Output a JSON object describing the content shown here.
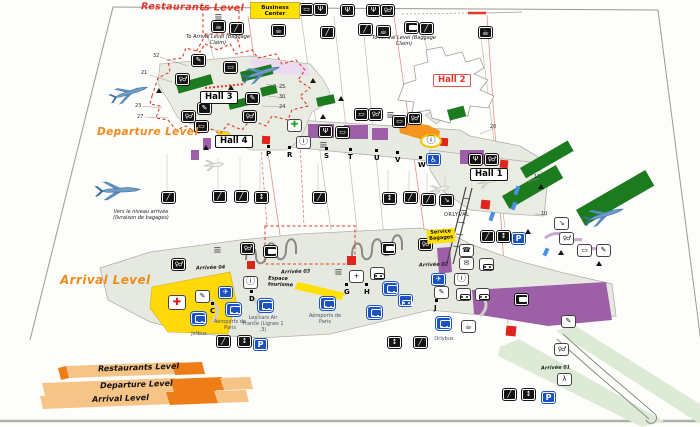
{
  "levels": {
    "restaurants": "Restaurants Level",
    "departure": "Departure Level",
    "arrival": "Arrival Level"
  },
  "legend": {
    "items": [
      "Restaurants Level",
      "Departure Level",
      "Arrival Level"
    ]
  },
  "badges": {
    "business_center": "Business Center",
    "service_bagages": "Service Bagages",
    "espace_tourisme": "Espace tourisme"
  },
  "notes": {
    "to_arrival": "To Arrival Level (Baggage Claim)",
    "vers_niveau": "Vers le niveau arrivée (livraison de bagages)",
    "orlyval": "ORLYVAL"
  },
  "halls": [
    {
      "label": "Hall 3",
      "x": 200,
      "y": 91,
      "cls": ""
    },
    {
      "label": "Hall 4",
      "x": 215,
      "y": 135,
      "cls": ""
    },
    {
      "label": "Hall 2",
      "x": 433,
      "y": 74,
      "cls": "red"
    },
    {
      "label": "Hall 1",
      "x": 470,
      "y": 168,
      "cls": ""
    }
  ],
  "arrival_exits": [
    {
      "label": "Arrivée 04",
      "x": 196,
      "y": 265
    },
    {
      "label": "Arrivée 03",
      "x": 281,
      "y": 269
    },
    {
      "label": "Arrivée 02",
      "x": 419,
      "y": 262
    },
    {
      "label": "Arrivée 01",
      "x": 541,
      "y": 365
    }
  ],
  "gate_letters": [
    {
      "t": "P",
      "x": 266,
      "y": 150
    },
    {
      "t": "R",
      "x": 287,
      "y": 151
    },
    {
      "t": "S",
      "x": 324,
      "y": 152
    },
    {
      "t": "T",
      "x": 348,
      "y": 153
    },
    {
      "t": "U",
      "x": 374,
      "y": 154
    },
    {
      "t": "V",
      "x": 395,
      "y": 156
    },
    {
      "t": "W",
      "x": 418,
      "y": 161
    },
    {
      "t": "C",
      "x": 210,
      "y": 307
    },
    {
      "t": "D",
      "x": 249,
      "y": 295
    },
    {
      "t": "G",
      "x": 344,
      "y": 288
    },
    {
      "t": "H",
      "x": 364,
      "y": 288
    },
    {
      "t": "J",
      "x": 434,
      "y": 304
    }
  ],
  "gate_numbers": [
    {
      "t": "32",
      "x": 153,
      "y": 53
    },
    {
      "t": "21",
      "x": 141,
      "y": 70
    },
    {
      "t": "23",
      "x": 135,
      "y": 103
    },
    {
      "t": "27",
      "x": 137,
      "y": 114
    },
    {
      "t": "25",
      "x": 279,
      "y": 84
    },
    {
      "t": "30",
      "x": 279,
      "y": 94
    },
    {
      "t": "24",
      "x": 279,
      "y": 104
    },
    {
      "t": "20",
      "x": 490,
      "y": 124
    },
    {
      "t": "11",
      "x": 534,
      "y": 174
    },
    {
      "t": "10",
      "x": 541,
      "y": 211
    }
  ],
  "transport": [
    {
      "label": "Jetbus",
      "lx": 184,
      "ly": 331,
      "w": 30,
      "ix": 191,
      "iy": 312,
      "name": "jetbus-stop"
    },
    {
      "label": "Aéroports de Paris",
      "lx": 212,
      "ly": 319,
      "w": 36,
      "ix": 226,
      "iy": 303,
      "name": "aeroports-de-paris-stop"
    },
    {
      "label": "Les cars Air France (Lignes 1 ,3)",
      "lx": 242,
      "ly": 315,
      "w": 42,
      "ix": 258,
      "iy": 299,
      "name": "cars-air-france-stop"
    },
    {
      "label": "Aéroports de Paris",
      "lx": 306,
      "ly": 313,
      "w": 38,
      "ix": 320,
      "iy": 297,
      "name": "aeroports-de-paris-stop-2"
    },
    {
      "label": "Orlybus",
      "lx": 426,
      "ly": 336,
      "w": 36,
      "ix": 436,
      "iy": 317,
      "name": "orlybus-stop"
    }
  ],
  "icons": [
    {
      "n": "flight-info-monitor-icon",
      "t": "monitor",
      "x": 300,
      "y": 4,
      "v": "b"
    },
    {
      "n": "restaurant-icon",
      "t": "restaurant",
      "x": 314,
      "y": 4,
      "v": "b"
    },
    {
      "n": "restaurant-icon",
      "t": "restaurant",
      "x": 341,
      "y": 5,
      "v": "b"
    },
    {
      "n": "restaurant-icon",
      "t": "restaurant",
      "x": 367,
      "y": 5,
      "v": "b"
    },
    {
      "n": "toilets-icon",
      "t": "toilets",
      "x": 381,
      "y": 5,
      "v": "b"
    },
    {
      "n": "shop-shelves-icon",
      "t": "kiosk",
      "x": 212,
      "y": 12,
      "v": "lines"
    },
    {
      "n": "bar-icon",
      "t": "bar",
      "x": 212,
      "y": 21,
      "v": "b"
    },
    {
      "n": "escalator-icon",
      "t": "escalator",
      "x": 230,
      "y": 23,
      "v": "b"
    },
    {
      "n": "bar-icon",
      "t": "bar",
      "x": 272,
      "y": 25,
      "v": "b"
    },
    {
      "n": "escalator-icon",
      "t": "escalator",
      "x": 321,
      "y": 27,
      "v": "b"
    },
    {
      "n": "escalator-icon",
      "t": "escalator",
      "x": 359,
      "y": 24,
      "v": "b"
    },
    {
      "n": "bar-icon",
      "t": "bar",
      "x": 377,
      "y": 26,
      "v": "b"
    },
    {
      "n": "baggage-claim-icon",
      "t": "case",
      "x": 405,
      "y": 22,
      "v": "b"
    },
    {
      "n": "escalator-icon",
      "t": "escalator",
      "x": 420,
      "y": 23,
      "v": "b"
    },
    {
      "n": "bar-icon",
      "t": "bar",
      "x": 479,
      "y": 27,
      "v": "b"
    },
    {
      "n": "smoking-area-icon",
      "t": "smoking",
      "x": 192,
      "y": 55,
      "v": "b"
    },
    {
      "n": "flight-info-monitor-icon",
      "t": "monitor",
      "x": 224,
      "y": 62,
      "v": "b"
    },
    {
      "n": "toilets-icon",
      "t": "toilets",
      "x": 176,
      "y": 74,
      "v": "b"
    },
    {
      "n": "smoking-area-icon",
      "t": "smoking",
      "x": 246,
      "y": 93,
      "v": "b"
    },
    {
      "n": "smoking-area-icon",
      "t": "smoking",
      "x": 198,
      "y": 103,
      "v": "b"
    },
    {
      "n": "toilets-icon",
      "t": "toilets",
      "x": 182,
      "y": 111,
      "v": "b"
    },
    {
      "n": "toilets-icon",
      "t": "toilets",
      "x": 243,
      "y": 111,
      "v": "b"
    },
    {
      "n": "flight-info-monitor-icon",
      "t": "monitor",
      "x": 195,
      "y": 121,
      "v": "b"
    },
    {
      "n": "flight-info-monitor-icon",
      "t": "monitor",
      "x": 355,
      "y": 109,
      "v": "b"
    },
    {
      "n": "toilets-icon",
      "t": "toilets",
      "x": 369,
      "y": 109,
      "v": "b"
    },
    {
      "n": "shop-shelves-icon",
      "t": "kiosk",
      "x": 384,
      "y": 110,
      "v": "lines"
    },
    {
      "n": "pharmacy-icon",
      "t": "pharmacy",
      "x": 288,
      "y": 120,
      "v": "w"
    },
    {
      "n": "restaurant-icon",
      "t": "restaurant",
      "x": 319,
      "y": 126,
      "v": "b"
    },
    {
      "n": "flight-info-monitor-icon",
      "t": "monitor",
      "x": 336,
      "y": 127,
      "v": "b"
    },
    {
      "n": "flight-info-monitor-icon",
      "t": "monitor",
      "x": 393,
      "y": 116,
      "v": "b"
    },
    {
      "n": "toilets-icon",
      "t": "toilets",
      "x": 408,
      "y": 113,
      "v": "b"
    },
    {
      "n": "information-icon",
      "t": "info",
      "x": 297,
      "y": 137,
      "v": "w"
    },
    {
      "n": "checkin-desks-icon",
      "t": "kiosk",
      "x": 317,
      "y": 140,
      "v": "lines"
    },
    {
      "n": "information-desk-icon",
      "t": "info",
      "x": 420,
      "y": 134,
      "v": "o"
    },
    {
      "n": "restaurant-icon",
      "t": "restaurant",
      "x": 469,
      "y": 154,
      "v": "b"
    },
    {
      "n": "toilets-icon",
      "t": "toilets",
      "x": 485,
      "y": 154,
      "v": "b"
    },
    {
      "n": "wheelchair-access-icon",
      "t": "wheelchair",
      "x": 427,
      "y": 154,
      "v": "u"
    },
    {
      "n": "escalator-icon",
      "t": "escalator",
      "x": 162,
      "y": 192,
      "v": "b"
    },
    {
      "n": "escalator-icon",
      "t": "escalator",
      "x": 213,
      "y": 191,
      "v": "b"
    },
    {
      "n": "escalator-icon",
      "t": "escalator",
      "x": 235,
      "y": 191,
      "v": "b"
    },
    {
      "n": "elevator-icon",
      "t": "elevator",
      "x": 255,
      "y": 192,
      "v": "b"
    },
    {
      "n": "escalator-icon",
      "t": "escalator",
      "x": 313,
      "y": 192,
      "v": "b"
    },
    {
      "n": "elevator-icon",
      "t": "elevator",
      "x": 383,
      "y": 193,
      "v": "b"
    },
    {
      "n": "escalator-icon",
      "t": "escalator",
      "x": 404,
      "y": 192,
      "v": "b"
    },
    {
      "n": "escalator-icon",
      "t": "escalator",
      "x": 422,
      "y": 194,
      "v": "b"
    },
    {
      "n": "stairs-icon",
      "t": "stairs",
      "x": 440,
      "y": 195,
      "v": "b"
    },
    {
      "n": "stairs-icon",
      "t": "stairs",
      "x": 555,
      "y": 218,
      "v": "w"
    },
    {
      "n": "toilets-icon",
      "t": "toilets",
      "x": 560,
      "y": 233,
      "v": "w"
    },
    {
      "n": "flight-info-monitor-icon",
      "t": "monitor",
      "x": 578,
      "y": 245,
      "v": "w"
    },
    {
      "n": "smoking-area-icon",
      "t": "smoking",
      "x": 597,
      "y": 245,
      "v": "w"
    },
    {
      "n": "escalator-icon",
      "t": "escalator",
      "x": 481,
      "y": 231,
      "v": "b"
    },
    {
      "n": "elevator-icon",
      "t": "elevator",
      "x": 497,
      "y": 231,
      "v": "b"
    },
    {
      "n": "parking-icon",
      "t": "parking",
      "x": 512,
      "y": 233,
      "v": "u"
    },
    {
      "n": "toilets-icon",
      "t": "toilets",
      "x": 241,
      "y": 243,
      "v": "b"
    },
    {
      "n": "shop-shelves-icon",
      "t": "kiosk",
      "x": 211,
      "y": 245,
      "v": "lines"
    },
    {
      "n": "toilets-icon",
      "t": "toilets",
      "x": 172,
      "y": 259,
      "v": "b"
    },
    {
      "n": "shop-shelves-icon",
      "t": "kiosk",
      "x": 332,
      "y": 267,
      "v": "lines"
    },
    {
      "n": "toilets-icon",
      "t": "toilets",
      "x": 419,
      "y": 239,
      "v": "b"
    },
    {
      "n": "phone-icon",
      "t": "phone",
      "x": 460,
      "y": 245,
      "v": "w"
    },
    {
      "n": "mail-icon",
      "t": "mail",
      "x": 460,
      "y": 258,
      "v": "w"
    },
    {
      "n": "car-rental-icon",
      "t": "car",
      "x": 480,
      "y": 259,
      "v": "w"
    },
    {
      "n": "flight-connections-icon",
      "t": "transfer",
      "x": 432,
      "y": 274,
      "v": "u"
    },
    {
      "n": "information-icon",
      "t": "info",
      "x": 455,
      "y": 274,
      "v": "w"
    },
    {
      "n": "smoking-area-icon",
      "t": "smoking",
      "x": 435,
      "y": 287,
      "v": "w"
    },
    {
      "n": "shuttle-bus-icon",
      "t": "car",
      "x": 457,
      "y": 289,
      "v": "w"
    },
    {
      "n": "car-rental-icon",
      "t": "car",
      "x": 476,
      "y": 289,
      "v": "w"
    },
    {
      "n": "baggage-icon",
      "t": "case",
      "x": 515,
      "y": 294,
      "v": "b"
    },
    {
      "n": "first-aid-icon",
      "t": "firstaid",
      "x": 169,
      "y": 296,
      "v": "w"
    },
    {
      "n": "smoking-area-icon",
      "t": "smoking",
      "x": 196,
      "y": 291,
      "v": "w"
    },
    {
      "n": "flight-connections-icon",
      "t": "transfer",
      "x": 219,
      "y": 287,
      "v": "u"
    },
    {
      "n": "information-icon",
      "t": "info",
      "x": 244,
      "y": 277,
      "v": "w"
    },
    {
      "n": "meeting-point-icon",
      "t": "meeting",
      "x": 350,
      "y": 271,
      "v": "w"
    },
    {
      "n": "car-rental-icon",
      "t": "car",
      "x": 371,
      "y": 268,
      "v": "w"
    },
    {
      "n": "shuttle-bus-icon",
      "t": "bus",
      "x": 383,
      "y": 282,
      "v": "u"
    },
    {
      "n": "taxi-icon",
      "t": "car",
      "x": 399,
      "y": 295,
      "v": "u"
    },
    {
      "n": "shuttle-bus-icon",
      "t": "bus",
      "x": 367,
      "y": 306,
      "v": "u"
    },
    {
      "n": "bar-icon",
      "t": "bar",
      "x": 462,
      "y": 321,
      "v": "w"
    },
    {
      "n": "elevator-icon",
      "t": "elevator",
      "x": 388,
      "y": 337,
      "v": "b"
    },
    {
      "n": "escalator-icon",
      "t": "escalator",
      "x": 414,
      "y": 337,
      "v": "b"
    },
    {
      "n": "smoking-area-icon",
      "t": "smoking",
      "x": 562,
      "y": 316,
      "v": "w"
    },
    {
      "n": "toilets-icon",
      "t": "toilets",
      "x": 555,
      "y": 344,
      "v": "w"
    },
    {
      "n": "moving-walkway-icon",
      "t": "walkway",
      "x": 558,
      "y": 374,
      "v": "w"
    },
    {
      "n": "escalator-icon",
      "t": "escalator",
      "x": 503,
      "y": 389,
      "v": "b"
    },
    {
      "n": "elevator-icon",
      "t": "elevator",
      "x": 522,
      "y": 389,
      "v": "b"
    },
    {
      "n": "parking-icon",
      "t": "parking",
      "x": 542,
      "y": 392,
      "v": "u"
    },
    {
      "n": "escalator-icon",
      "t": "escalator",
      "x": 217,
      "y": 336,
      "v": "b"
    },
    {
      "n": "elevator-icon",
      "t": "elevator",
      "x": 238,
      "y": 336,
      "v": "b"
    },
    {
      "n": "parking-icon",
      "t": "parking",
      "x": 254,
      "y": 339,
      "v": "u"
    },
    {
      "n": "baggage-carousel-icon",
      "t": "case",
      "x": 264,
      "y": 246,
      "v": "b"
    },
    {
      "n": "baggage-carousel-icon",
      "t": "case",
      "x": 382,
      "y": 243,
      "v": "b"
    }
  ],
  "colors": {
    "title_red": "#e23327",
    "title_orange": "#f08a1d",
    "badge_yellow": "#ffe000",
    "gate_green": "#1c7a1f",
    "shop_purple": "#9d5fa8",
    "block_orange": "#f5941e",
    "floor": "#e7eae1",
    "walkway_green": "#dcead6",
    "alert_red": "#e0261c",
    "icon_blue": "#1d53c0"
  }
}
